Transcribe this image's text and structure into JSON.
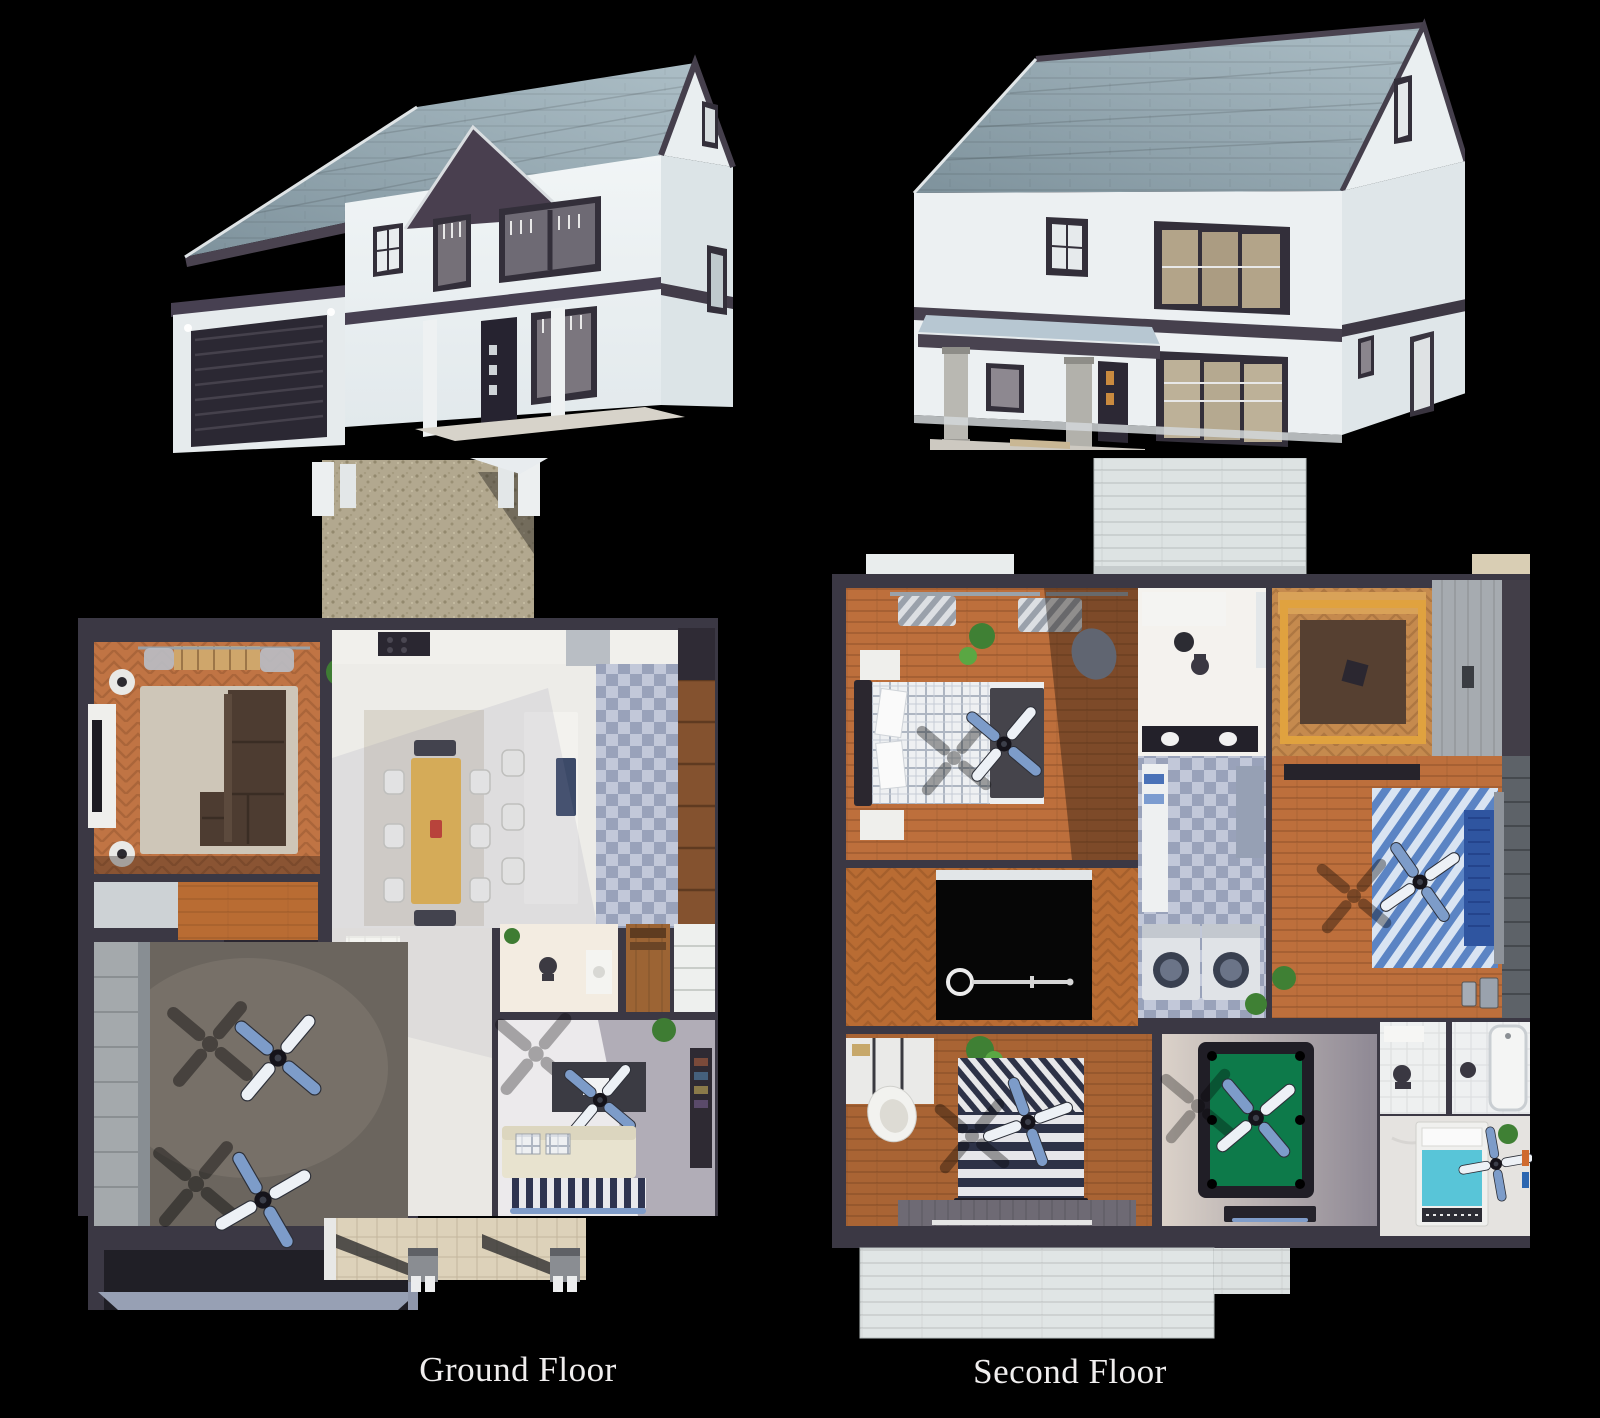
{
  "page": {
    "background": "#000000",
    "width": 1600,
    "height": 1418
  },
  "captions": {
    "ground": "Ground Floor",
    "second": "Second Floor"
  },
  "palette": {
    "roof_shingles": "#93a7b0",
    "trim_dark": "#49424f",
    "siding_white": "#edf1f2",
    "wood_floor": "#bd6f3c",
    "kitchen_tile": "#a3abc2",
    "pool_table_felt": "#0d7a4a",
    "fan_blade_accent": "#7d9cc9",
    "dining_table": "#e2b24c",
    "gravel_path": "#b2a88f",
    "caption_text": "#f0eeee"
  },
  "figures": {
    "house_view_a": {
      "icon": "house-3d-render-front-left-view"
    },
    "house_view_b": {
      "icon": "house-3d-render-front-right-view"
    },
    "ground_floor_plan": {
      "icon": "ground-floor-3d-plan-render"
    },
    "second_floor_plan": {
      "icon": "second-floor-3d-plan-render"
    }
  }
}
